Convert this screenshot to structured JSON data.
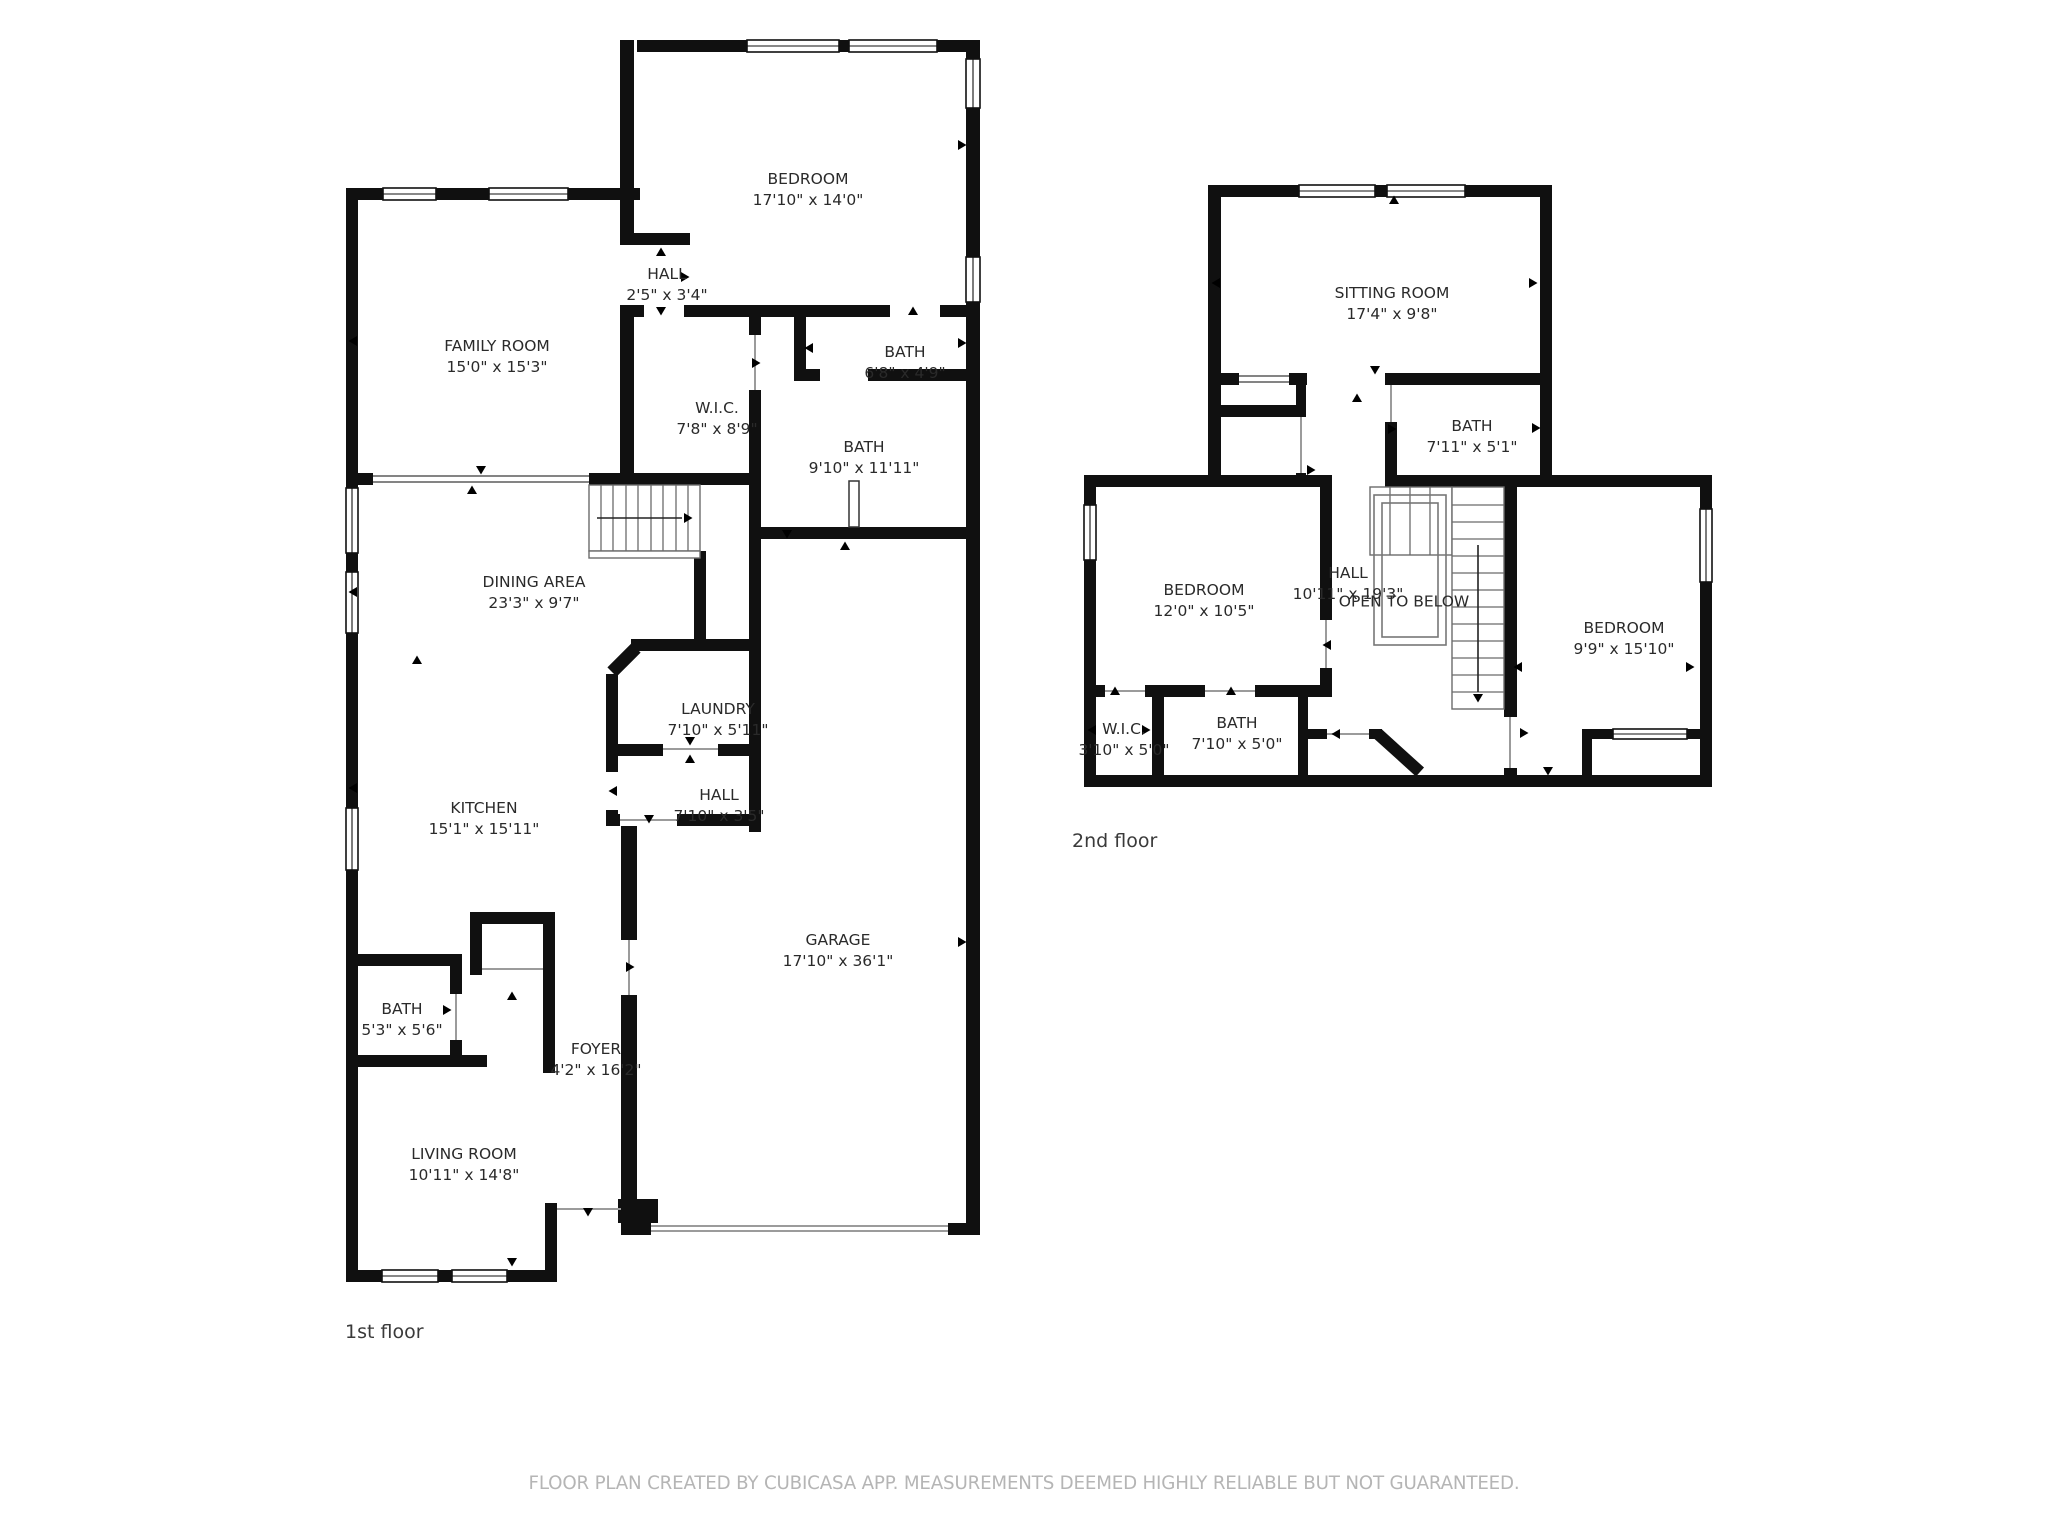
{
  "floor_plan": {
    "floors": [
      {
        "label": "1st floor"
      },
      {
        "label": "2nd floor"
      }
    ],
    "rooms": [
      {
        "name": "BEDROOM",
        "dims": "17'10\" x 14'0\""
      },
      {
        "name": "HALL",
        "dims": "2'5\" x 3'4\""
      },
      {
        "name": "FAMILY ROOM",
        "dims": "15'0\" x 15'3\""
      },
      {
        "name": "W.I.C.",
        "dims": "7'8\" x 8'9\""
      },
      {
        "name": "BATH",
        "dims": "6'8\" x 4'9\""
      },
      {
        "name": "BATH",
        "dims": "9'10\" x 11'11\""
      },
      {
        "name": "DINING AREA",
        "dims": "23'3\" x 9'7\""
      },
      {
        "name": "LAUNDRY",
        "dims": "7'10\" x 5'11\""
      },
      {
        "name": "KITCHEN",
        "dims": "15'1\" x 15'11\""
      },
      {
        "name": "HALL",
        "dims": "7'10\" x 3'5\""
      },
      {
        "name": "GARAGE",
        "dims": "17'10\" x 36'1\""
      },
      {
        "name": "BATH",
        "dims": "5'3\" x 5'6\""
      },
      {
        "name": "FOYER",
        "dims": "4'2\" x 16'2\""
      },
      {
        "name": "LIVING ROOM",
        "dims": "10'11\" x 14'8\""
      },
      {
        "name": "SITTING ROOM",
        "dims": "17'4\" x 9'8\""
      },
      {
        "name": "BATH",
        "dims": "7'11\" x 5'1\""
      },
      {
        "name": "BEDROOM",
        "dims": "12'0\" x 10'5\""
      },
      {
        "name": "HALL",
        "dims": "10'11\" x 19'3\""
      },
      {
        "name": "BEDROOM",
        "dims": "9'9\" x 15'10\""
      },
      {
        "name": "W.I.C.",
        "dims": "3'10\" x 5'0\""
      },
      {
        "name": "BATH",
        "dims": "7'10\" x 5'0\""
      }
    ],
    "annotations": {
      "open_to_below": "OPEN TO BELOW"
    },
    "footer": {
      "text": "FLOOR PLAN CREATED BY CUBICASA APP. MEASUREMENTS DEEMED HIGHLY RELIABLE BUT NOT GUARANTEED."
    },
    "colors": {
      "wall": "#101010",
      "label_text": "#2a2a2a",
      "floor_label_text": "#3a3a3a",
      "footer_text": "#b5b5b5",
      "stair_line": "#6b6b6b",
      "door_line": "#9b9b9b",
      "background": "#ffffff"
    }
  }
}
